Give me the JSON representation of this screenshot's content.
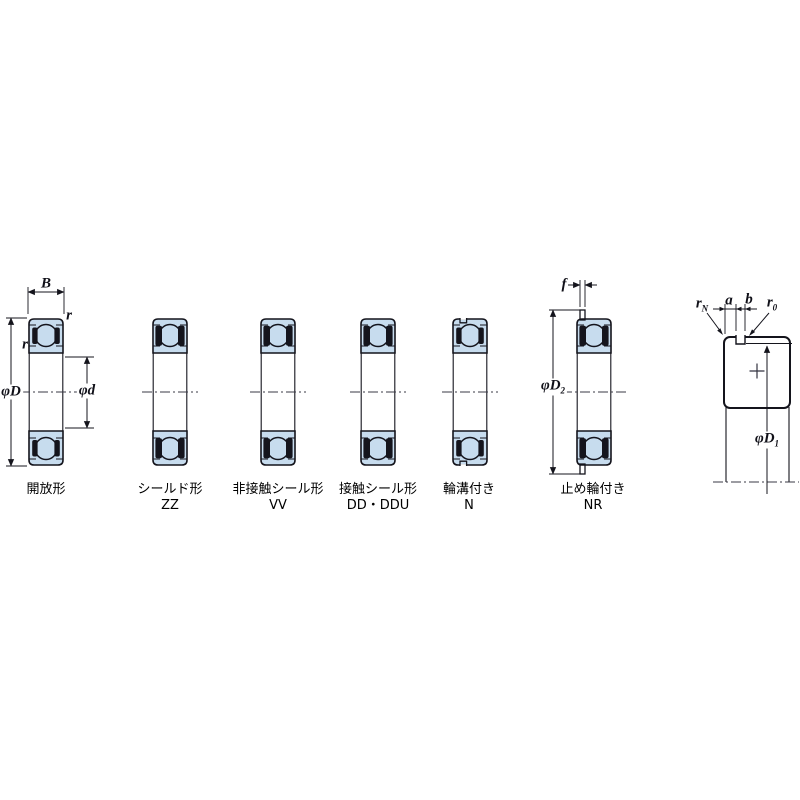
{
  "figure": {
    "bearings": [
      {
        "name": "開放形",
        "code": ""
      },
      {
        "name": "シールド形",
        "code": "ZZ"
      },
      {
        "name": "非接触シール形",
        "code": "VV"
      },
      {
        "name": "接触シール形",
        "code": "DD・DDU"
      },
      {
        "name": "輪溝付き",
        "code": "N"
      },
      {
        "name": "止め輪付き",
        "code": "NR"
      }
    ],
    "dims": {
      "B": "B",
      "r_outer": "r",
      "r_inner": "r",
      "phiD": "φD",
      "phid": "φd",
      "f": "f",
      "phiD2_main": "φD",
      "phiD2_sub": "2",
      "phiD1_main": "φD",
      "phiD1_sub": "1",
      "rN_main": "r",
      "rN_sub": "N",
      "r0_main": "r",
      "r0_sub": "0",
      "a": "a",
      "b": "b"
    },
    "colors": {
      "background": "#ffffff",
      "bearing_fill": "#c7dcee",
      "line_color": "#14141c",
      "seal_color": "#15151d"
    }
  }
}
